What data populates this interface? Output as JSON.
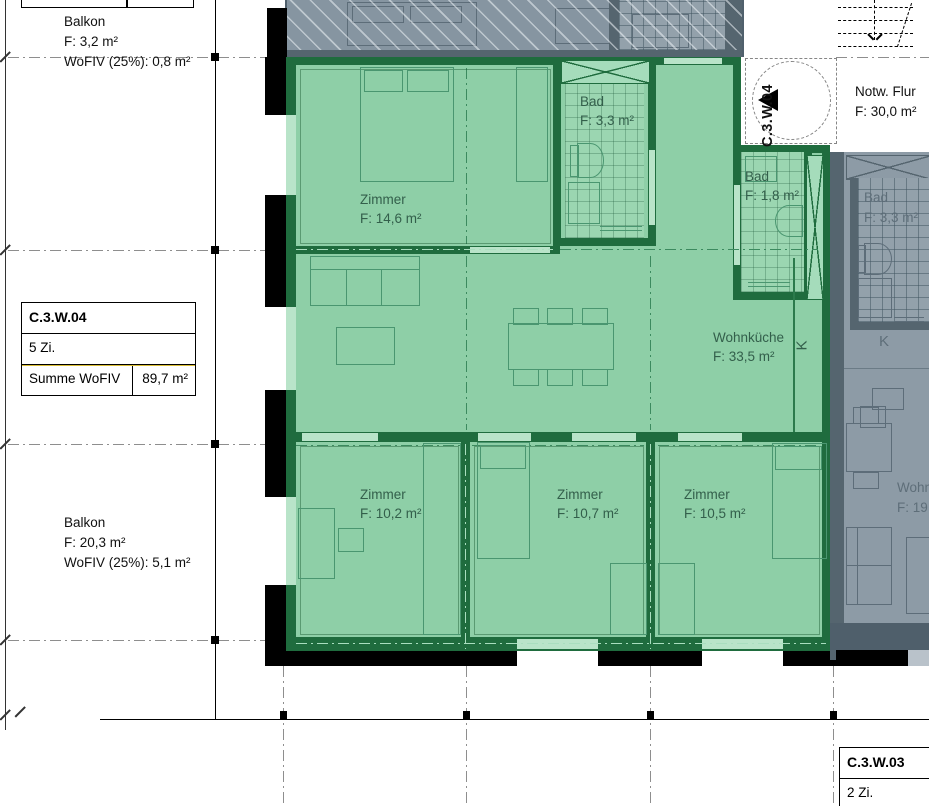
{
  "colors": {
    "green_floor": "#8ecfa7",
    "green_wall": "#1f6c3e",
    "green_window": "#b9e4c9",
    "green_text": "#335f4b",
    "gray_floor": "#8d9ba6",
    "gray_wall": "#55656f",
    "gray_text": "#5e6e79",
    "accent_yellow": "#d9bc35",
    "wall_black": "#000000"
  },
  "unit": {
    "marker_label": "C.3.W.04",
    "kitchen_label": "K",
    "rooms": [
      {
        "name": "Zimmer",
        "area": "F: 14,6 m²"
      },
      {
        "name": "Bad",
        "area": "F: 3,3 m²"
      },
      {
        "name": "Bad",
        "area": "F: 1,8 m²"
      },
      {
        "name": "Wohnküche",
        "area": "F: 33,5 m²"
      },
      {
        "name": "Zimmer",
        "area": "F: 10,2 m²"
      },
      {
        "name": "Zimmer",
        "area": "F: 10,7 m²"
      },
      {
        "name": "Zimmer",
        "area": "F: 10,5 m²"
      }
    ]
  },
  "balconies": {
    "top": {
      "name": "Balkon",
      "area": "F: 3,2 m²",
      "wofiv": "WoFIV (25%): 0,8 m²"
    },
    "left": {
      "name": "Balkon",
      "area": "F: 20,3 m²",
      "wofiv": "WoFIV (25%): 5,1 m²"
    }
  },
  "corridor": {
    "name": "Notw. Flur",
    "area": "F: 30,0 m²"
  },
  "info_table": {
    "title": "C.3.W.04",
    "rooms": "5 Zi.",
    "sum_label": "Summe WoFIV",
    "sum_value": "89,7 m²"
  },
  "info_table_2": {
    "title": "C.3.W.03",
    "rooms": "2 Zi."
  },
  "neighbor": {
    "bad_name": "Bad",
    "bad_area": "F: 3,3 m²",
    "kitchen_label": "K",
    "living_name": "Wohn",
    "living_area": "F: 19"
  }
}
